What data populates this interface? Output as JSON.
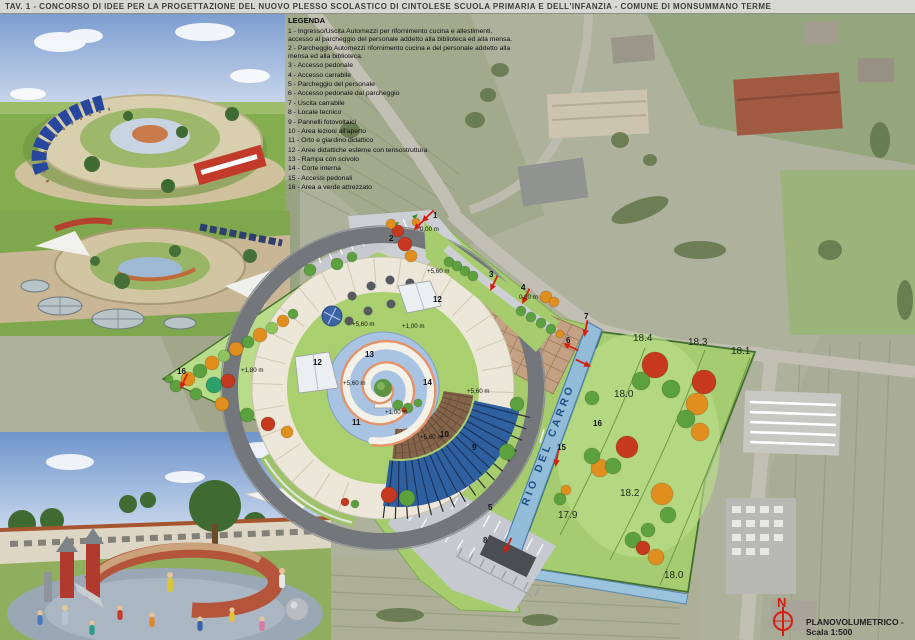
{
  "title": "TAV. 1 - CONCORSO DI IDEE PER LA PROGETTAZIONE DEL NUOVO PLESSO SCOLASTICO DI CINTOLESE SCUOLA PRIMARIA E DELL'INFANZIA - COMUNE DI MONSUMMANO TERME",
  "legend": {
    "heading": "LEGENDA",
    "items": [
      "1 - Ingresso/Uscita Automezzi per rifornimento cucina e allestimenti, accesso al parcheggio del personale addetto alla biblioteca ed alla mensa.",
      "2 - Parcheggio Automezzi rifornimento cucina e del personale addetto alla mensa ed alla biblioteca.",
      "3 - Accesso pedonale",
      "4 - Accesso carrabile",
      "5 - Parcheggio del personale",
      "6 - Accesso pedonale dal parcheggio",
      "7 - Uscita carrabile",
      "8 - Locale tecnico",
      "9 - Pannelli fotovoltaici",
      "10 - Area lezioni all'aperto",
      "11 - Orto e giardino didattico",
      "12 - Aree didattiche esterne con tensostruttura",
      "13 - Rampa con scivolo",
      "14 - Corte interna",
      "15 - Accessi pedonali",
      "16 - Area a verde attrezzato"
    ]
  },
  "plan": {
    "stream_label": "RIO DEL CARRO",
    "markers": [
      {
        "t": "1",
        "x": 433,
        "y": 218
      },
      {
        "t": "2",
        "x": 389,
        "y": 241
      },
      {
        "t": "3",
        "x": 489,
        "y": 277
      },
      {
        "t": "4",
        "x": 521,
        "y": 290
      },
      {
        "t": "5",
        "x": 488,
        "y": 510
      },
      {
        "t": "6",
        "x": 566,
        "y": 343
      },
      {
        "t": "7",
        "x": 584,
        "y": 319
      },
      {
        "t": "8",
        "x": 483,
        "y": 543
      },
      {
        "t": "9",
        "x": 472,
        "y": 450
      },
      {
        "t": "10",
        "x": 440,
        "y": 437
      },
      {
        "t": "11",
        "x": 352,
        "y": 425
      },
      {
        "t": "12",
        "x": 433,
        "y": 302
      },
      {
        "t": "12",
        "x": 313,
        "y": 365
      },
      {
        "t": "13",
        "x": 365,
        "y": 357
      },
      {
        "t": "14",
        "x": 423,
        "y": 385
      },
      {
        "t": "15",
        "x": 557,
        "y": 450
      },
      {
        "t": "16",
        "x": 177,
        "y": 374
      },
      {
        "t": "16",
        "x": 593,
        "y": 426
      }
    ],
    "elevations": [
      {
        "t": "0,00 m",
        "x": 420,
        "y": 231
      },
      {
        "t": "0,00 m",
        "x": 519,
        "y": 299
      },
      {
        "t": "+5,60 m",
        "x": 427,
        "y": 273
      },
      {
        "t": "+5,60 m",
        "x": 352,
        "y": 326
      },
      {
        "t": "+5,60 m",
        "x": 343,
        "y": 385
      },
      {
        "t": "+5,60 m",
        "x": 467,
        "y": 393
      },
      {
        "t": "+5,60 m",
        "x": 420,
        "y": 439
      },
      {
        "t": "+1,00 m",
        "x": 402,
        "y": 328
      },
      {
        "t": "+1,00 m",
        "x": 385,
        "y": 414
      },
      {
        "t": "+1,80 m",
        "x": 241,
        "y": 372
      }
    ],
    "field_elevations": [
      {
        "t": "18.4",
        "x": 633,
        "y": 341
      },
      {
        "t": "18.3",
        "x": 688,
        "y": 345
      },
      {
        "t": "18.1",
        "x": 731,
        "y": 354
      },
      {
        "t": "18.0",
        "x": 614,
        "y": 397
      },
      {
        "t": "18.2",
        "x": 620,
        "y": 496
      },
      {
        "t": "17.9",
        "x": 558,
        "y": 518
      },
      {
        "t": "18.0",
        "x": 664,
        "y": 578
      }
    ]
  },
  "footer": {
    "north_label": "N",
    "caption": "PLANOVOLUMETRICO - Scala 1:500"
  },
  "palette": {
    "lawn": "#a6cc6e",
    "field": "#a5cc70",
    "paving": "#c6cad0",
    "ring_road": "#73777c",
    "building_ring": "#ece7d8",
    "pond": "#a9c3e2",
    "stream": "#93bcd9",
    "roof_wood": "#84644a",
    "photovoltaic": "#2e5f9e",
    "tensile": "#c4a183",
    "marker_red": "#d42010"
  }
}
